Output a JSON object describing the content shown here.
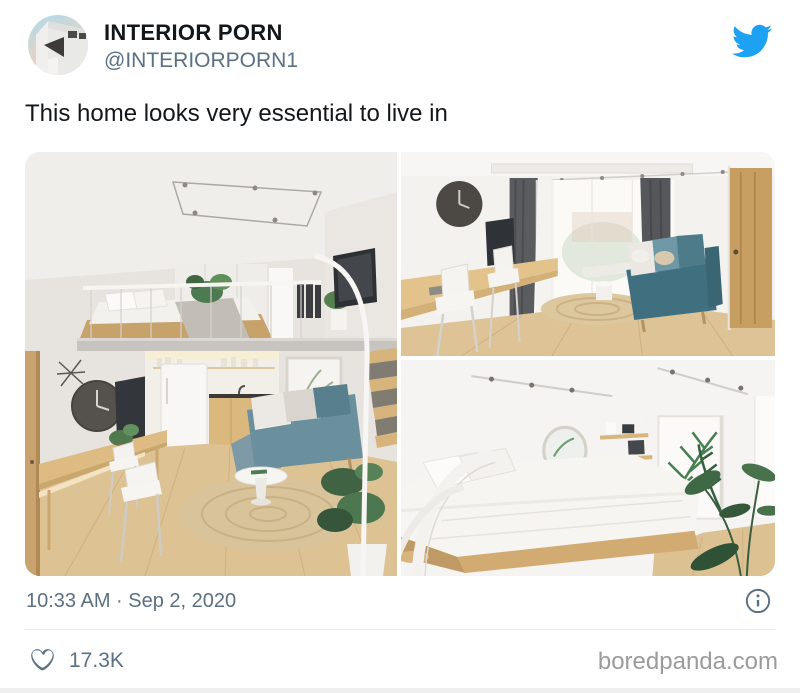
{
  "colors": {
    "accent_twitter_blue": "#1DA1F2",
    "text_primary": "#14171a",
    "text_secondary": "#5b7083",
    "watermark_gray": "#9b9b9b",
    "divider": "#e6ecf0"
  },
  "header": {
    "name": "INTERIOR PORN",
    "handle": "@INTERIORPORN1",
    "avatar_icon": "white-modern-building-on-pastel-sky-avatar",
    "brand_icon": "twitter-bird-icon"
  },
  "tweet": {
    "text": "This home looks very essential to live in"
  },
  "photos": {
    "count": 3,
    "items": [
      {
        "id": "loft-apartment",
        "description": "Loft apartment with mezzanine bed above, kitchen nook, blue sofa, round white table, jute rug and wooden staircase"
      },
      {
        "id": "living-room",
        "description": "Living room with long wooden wall desk, white chairs, window with dark curtains, teal sofa and wooden door"
      },
      {
        "id": "bedroom",
        "description": "Bedroom with white bed on wooden platform, round mirror, shelves, palm-leaf wall art and potted plant"
      }
    ]
  },
  "meta": {
    "timestamp": "10:33 AM · Sep 2, 2020",
    "info_icon": "info-circle-icon"
  },
  "engagement": {
    "like_icon": "heart-outline-icon",
    "like_count": "17.3K"
  },
  "watermark": {
    "text": "boredpanda.com"
  }
}
